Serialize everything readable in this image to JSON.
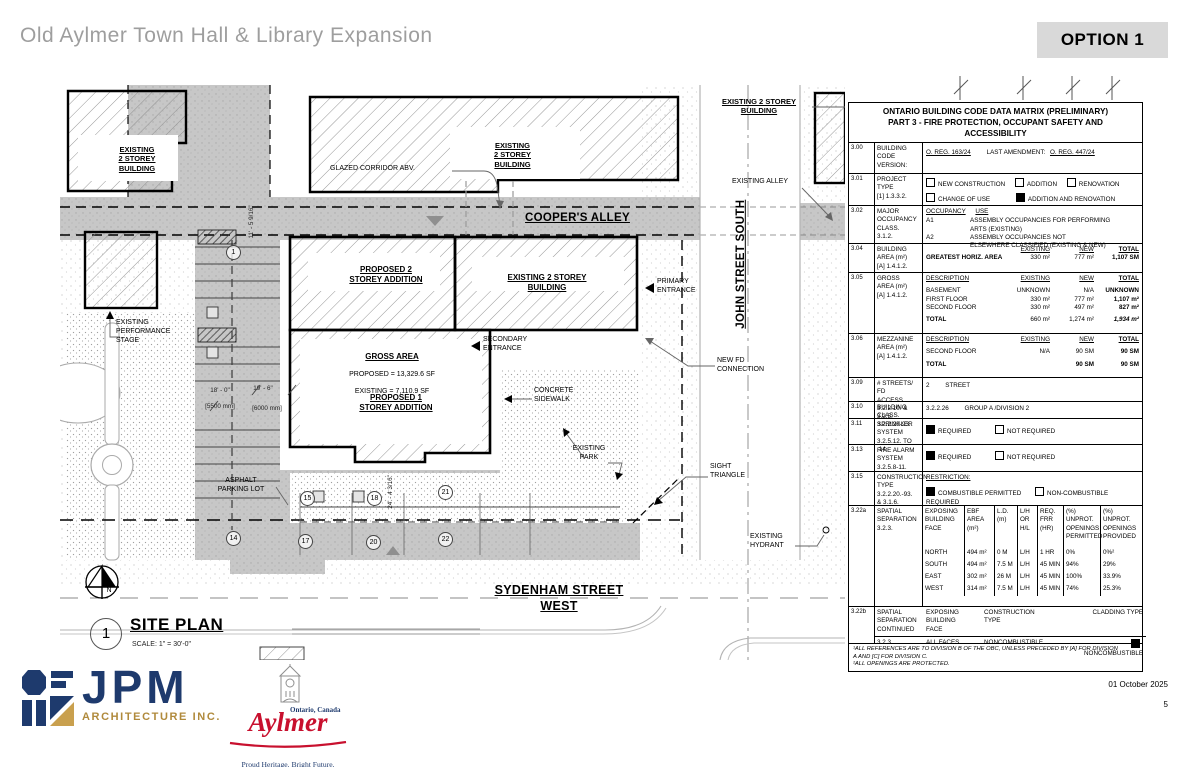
{
  "header": {
    "title": "Old Aylmer Town Hall & Library Expansion",
    "option": "OPTION 1"
  },
  "footer": {
    "date": "01 October 2025",
    "page": "5"
  },
  "logos": {
    "jpm": {
      "name": "JPM",
      "subtitle": "ARCHITECTURE INC."
    },
    "aylmer": {
      "name": "Aylmer",
      "region": "Ontario, Canada",
      "tagline": "Proud Heritage. Bright Future."
    }
  },
  "plan": {
    "streets": {
      "coopers_alley": "COOPER'S ALLEY",
      "john_street": "JOHN STREET SOUTH",
      "sydenham": "SYDENHAM STREET WEST"
    },
    "buildings": {
      "existing_tl": "EXISTING\n2 STOREY\nBUILDING",
      "existing_tm": "EXISTING\n2 STOREY\nBUILDING",
      "existing_tr": "EXISTING 2 STOREY\nBUILDING",
      "proposed2": "PROPOSED 2\nSTOREY ADDITION",
      "existing_main": "EXISTING 2 STOREY\nBUILDING",
      "proposed1": "PROPOSED 1\nSTOREY ADDITION"
    },
    "gross_area": {
      "title": "GROSS AREA",
      "line1": "PROPOSED = 13,329.6 SF",
      "line2": "EXISTING = 7,110.9 SF"
    },
    "annotations": {
      "glazed_corridor": "GLAZED CORRIDOR ABV.",
      "existing_alley": "EXISTING ALLEY",
      "primary_entrance": "PRIMARY\nENTRANCE",
      "secondary_entrance": "SECONDARY\nENTRANCE",
      "new_fd": "NEW FD\nCONNECTION",
      "concrete_sidewalk": "CONCRETE\nSIDEWALK",
      "existing_park": "EXISTING\nPARK",
      "sight_triangle": "SIGHT\nTRIANGLE",
      "existing_hydrant": "EXISTING\nHYDRANT",
      "performance_stage": "EXISTING\nPERFORMANCE\nSTAGE",
      "asphalt_lot": "ASPHALT\nPARKING LOT"
    },
    "dimensions": {
      "d1": "18' - 0\"",
      "d1m": "[5500 mm]",
      "d2": "19' - 6\"",
      "d2m": "[6000 mm]",
      "v1": "11' - 5 9/16\"",
      "v2": "24' - 4 3/16\""
    },
    "stalls": [
      "15",
      "18",
      "21",
      "14",
      "17",
      "20",
      "22"
    ],
    "keynote": "1",
    "north": "N",
    "titleblock": {
      "number": "1",
      "title": "SITE PLAN",
      "scale": "SCALE:  1\" = 30'-0\""
    }
  },
  "obc": {
    "title": "ONTARIO BUILDING CODE DATA MATRIX (PRELIMINARY)\nPART 3 - FIRE PROTECTION, OCCUPANT SAFETY AND\nACCESSIBILITY",
    "r300": {
      "num": "3.00",
      "label": "BUILDING CODE\nVERSION:",
      "v1": "O. REG. 163/24",
      "l2": "LAST AMENDMENT:",
      "v2": "O. REG. 447/24"
    },
    "r301": {
      "num": "3.01",
      "label": "PROJECT\nTYPE\n[1] 1.3.3.2.",
      "o1": "NEW CONSTRUCTION",
      "o2": "ADDITION",
      "o3": "RENOVATION",
      "o4": "CHANGE OF USE",
      "o5": "ADDITION AND RENOVATION",
      "c1": false,
      "c2": false,
      "c3": false,
      "c4": false,
      "c5": true
    },
    "r302": {
      "num": "3.02",
      "label": "MAJOR\nOCCUPANCY\nCLASS.\n3.1.2.",
      "h1": "OCCUPANCY",
      "h2": "USE",
      "a1": "A1",
      "u1": "ASSEMBLY OCCUPANCIES FOR PERFORMING\nARTS (EXISTING)",
      "a2": "A2",
      "u2": "ASSEMBLY OCCUPANCIES NOT\nELSEWHERE CLASSIFIED (EXISTING & NEW)"
    },
    "r304": {
      "num": "3.04",
      "label": "BUILDING\nAREA (m²)\n[A] 1.4.1.2.",
      "hE": "EXISTING",
      "hN": "NEW",
      "hT": "TOTAL",
      "rowlabel": "GREATEST HORIZ. AREA",
      "e": "330 m²",
      "n": "777 m²",
      "t": "1,107 SM"
    },
    "r305": {
      "num": "3.05",
      "label": "GROSS\nAREA (m²)\n[A] 1.4.1.2.",
      "hD": "DESCRIPTION",
      "hE": "EXISTING",
      "hN": "NEW",
      "hT": "TOTAL",
      "rows": [
        [
          "BASEMENT",
          "UNKNOWN",
          "N/A",
          "UNKNOWN"
        ],
        [
          "FIRST FLOOR",
          "330 m²",
          "777 m²",
          "1,107 m²"
        ],
        [
          "SECOND FLOOR",
          "330 m²",
          "497 m²",
          "827 m²"
        ]
      ],
      "total": [
        "TOTAL",
        "660 m²",
        "1,274 m²",
        "1,934 m²"
      ]
    },
    "r306": {
      "num": "3.06",
      "label": "MEZZANINE\nAREA (m²)\n[A] 1.4.1.2.",
      "hD": "DESCRIPTION",
      "hE": "EXISTING",
      "hN": "NEW",
      "hT": "TOTAL",
      "row": [
        "SECOND FLOOR",
        "N/A",
        "90 SM",
        "90 SM"
      ],
      "total": [
        "TOTAL",
        "",
        "90 SM",
        "90 SM"
      ]
    },
    "r309": {
      "num": "3.09",
      "label": "# STREETS/ FD\nACCESS\n3.2.2.10. & 3.2.5.",
      "v1": "2",
      "v2": "STREET"
    },
    "r310": {
      "num": "3.10",
      "label": "BUILDING CLASS.\n3.2.2.20-93.",
      "v1": "3.2.2.26",
      "v2": "GROUP A /DIVISION 2"
    },
    "r311": {
      "num": "3.11",
      "label": "SPRINKLER\nSYSTEM\n3.2.5.12. TO .14.",
      "o1": "REQUIRED",
      "o2": "NOT REQUIRED",
      "c1": true,
      "c2": false
    },
    "r313": {
      "num": "3.13",
      "label": "FIRE ALARM\nSYSTEM\n3.2.5.8-11.",
      "o1": "REQUIRED",
      "o2": "NOT REQUIRED",
      "c1": true,
      "c2": false
    },
    "r315": {
      "num": "3.15",
      "label": "CONSTRUCTION\nTYPE\n3.2.2.20.-93.\n& 3.1.6.",
      "h": "RESTRICTION:",
      "o1": "COMBUSTIBLE PERMITTED",
      "o2": "NON-COMBUSTIBLE REQUIRED",
      "c1": true,
      "c2": false
    },
    "r322a": {
      "num": "3.22a",
      "label": "SPATIAL\nSEPARATION\n3.2.3.",
      "h0": "EXPOSING\nBUILDING\nFACE",
      "h1": "EBF\nAREA\n(m²)",
      "h2": "L.D.\n(m)",
      "h3": "L/H\nOR\nH/L",
      "h4": "REQ.\nFRR\n(HR)",
      "h5": "(%) UNPROT.\nOPENINGS\nPERMITTED",
      "h6": "(%) UNPROT.\nOPENINGS\nPROVIDED",
      "rows": [
        [
          "NORTH",
          "494 m²",
          "0 M",
          "L/H",
          "1 HR",
          "0%",
          "0%²"
        ],
        [
          "SOUTH",
          "494 m²",
          "7.5 M",
          "L/H",
          "45 MIN",
          "94%",
          "29%"
        ],
        [
          "EAST",
          "302 m²",
          "26 M",
          "L/H",
          "45 MIN",
          "100%",
          "33.9%"
        ],
        [
          "WEST",
          "314 m²",
          "7.5 M",
          "L/H",
          "45 MIN",
          "74%",
          "25.3%"
        ]
      ]
    },
    "r322b": {
      "num": "3.22b",
      "label": "SPATIAL\nSEPARATION\nCONTINUED",
      "label2": "3.2.3.",
      "h1": "EXPOSING\nBUILDING\nFACE",
      "h2": "CONSTRUCTION\nTYPE",
      "h3": "CLADDING TYPE",
      "v1": "ALL FACES",
      "v2": "NONCOMBUSTIBLE",
      "v3": "NONCOMBUSTIBLE",
      "c3": true
    },
    "footnotes": "¹ALL REFERENCES ARE TO DIVISION B OF THE OBC, UNLESS PRECEDED BY [A] FOR DIVISION\nA AND [C] FOR DIVISION C.\n²ALL OPENINGS ARE PROTECTED."
  }
}
